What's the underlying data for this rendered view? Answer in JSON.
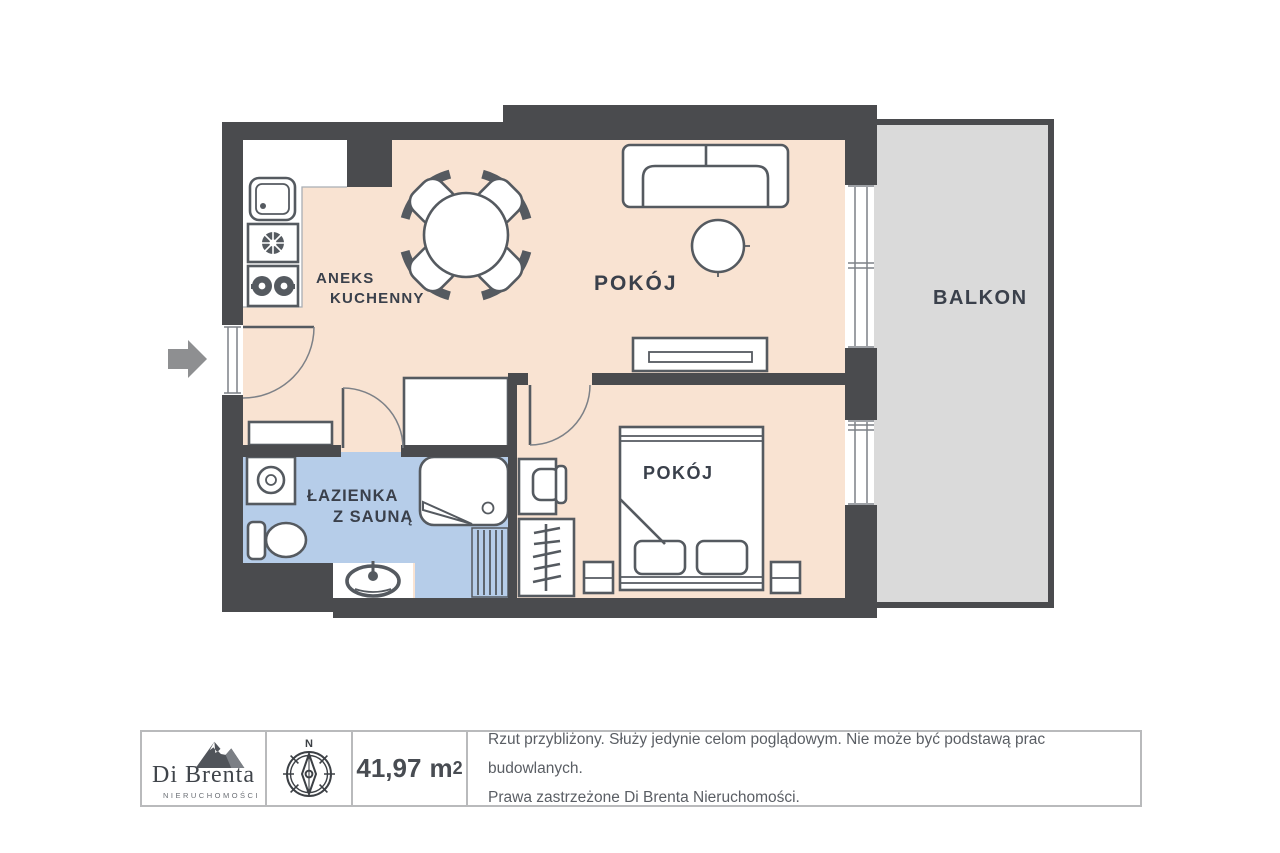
{
  "plan": {
    "rooms": {
      "kitchen": {
        "line1": "ANEKS",
        "line2": "KUCHENNY"
      },
      "living": {
        "label": "POKÓJ"
      },
      "balcony": {
        "label": "BALKON"
      },
      "bathroom": {
        "line1": "ŁAZIENKA",
        "line2": "Z SAUNĄ"
      },
      "bedroom": {
        "label": "POKÓJ"
      }
    }
  },
  "footer": {
    "brand": {
      "name": "Di Brenta",
      "subtitle": "NIERUCHOMOŚCI"
    },
    "compass": {
      "north": "N"
    },
    "area": {
      "value": "41,97",
      "unit": "m",
      "sup": "2"
    },
    "disclaimer": {
      "line1": "Rzut przybliżony. Służy jedynie celom poglądowym. Nie może być podstawą prac budowlanych.",
      "line2": "Prawa zastrzeżone Di Brenta Nieruchomości."
    }
  },
  "colors": {
    "wall": "#4a4b4e",
    "floor": "#f9e3d2",
    "bathroom_floor": "#b6cde9",
    "balcony_floor": "#dadada",
    "furniture_stroke": "#555a60",
    "label_text": "#3a404b",
    "footer_border": "#b9babc",
    "footer_text": "#5a5e64",
    "arrow": "#8e8f91"
  }
}
